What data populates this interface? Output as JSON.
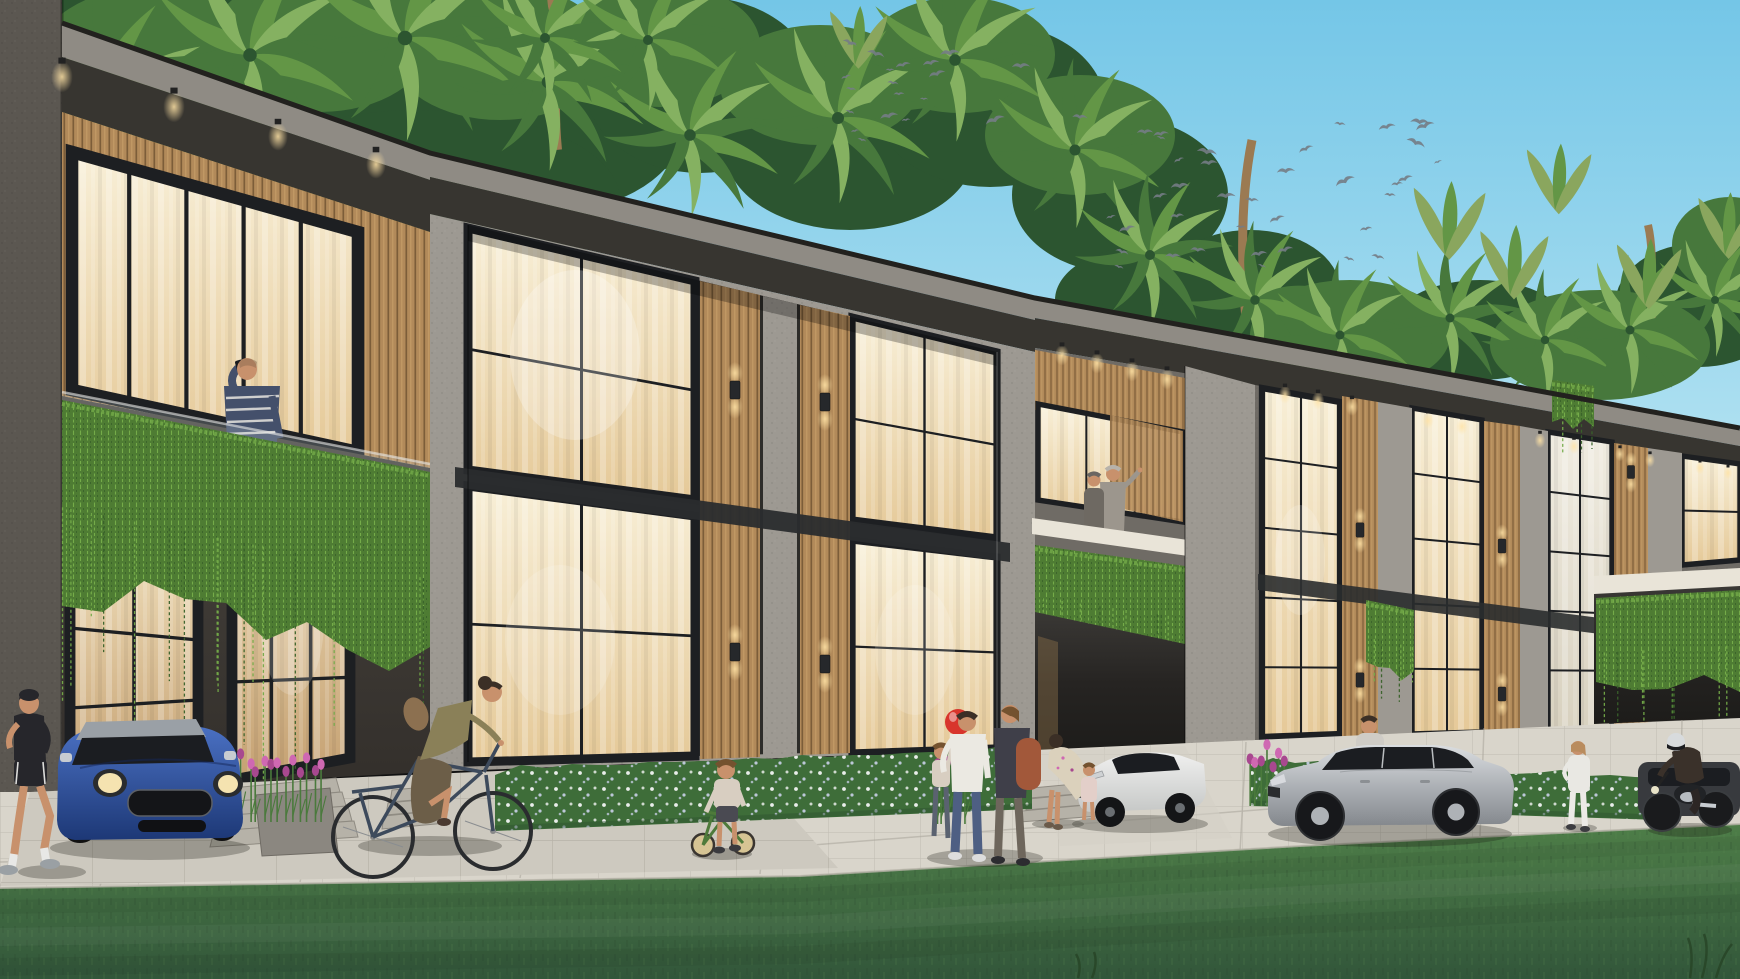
{
  "meta": {
    "title": "Architectural rendering of a modern two-storey tropical townhouse row at dusk",
    "type": "exterior-visualization",
    "no_visible_text": true
  },
  "palette": {
    "sky-top": "#74c6e7",
    "sky-bottom": "#c6ebf5",
    "canopy-dark": "#2c5530",
    "canopy-mid": "#47783c",
    "canopy-light": "#639646",
    "palm-light": "#85b161",
    "banana": "#8aa65e",
    "trunk": "#9b7a52",
    "bird": "#747c85",
    "fascia-light": "#8f8b84",
    "fascia-dark": "#373530",
    "roof-edge": "#22211e",
    "concrete-light": "#9d9992",
    "concrete-mid": "#6f6b65",
    "column": "#5b5751",
    "porch-1": "#49453f",
    "porch-2": "#332f2b",
    "reveal": "#2d2c29",
    "beam-dark": "#2a2c2e",
    "frame-black": "#1d1f22",
    "wood-mid": "#b28a5a",
    "wood-dark": "#7c5d39",
    "wood-light": "#caa26b",
    "glass-w1": "#f8efd7",
    "glass-w2": "#e5c998",
    "glass-p1": "#f0ece1",
    "glass-p2": "#d8d1bf",
    "door-w1": "#eedcb8",
    "door-w2": "#c5a172",
    "glow": "#ffdf9d",
    "vine": "#4e7c33",
    "vine-light": "#74ab49",
    "vine-dark": "#39622a",
    "hedge": "#3e6d39",
    "hedge-dark": "#2d5230",
    "flower-white": "#e9edea",
    "flower-blue": "#c3cbe0",
    "tulip": "#cf68b2",
    "tulip-deep": "#a8488f",
    "stem": "#4a7a3c",
    "slab-white": "#e9e4d8",
    "rail-glass": "#cfdade",
    "lawn-1": "#4e7e48",
    "lawn-2": "#32563a",
    "walkway": "#d9d5cb",
    "apron": "#cdc9bf",
    "paver-line": "#a8a49a",
    "step": "#b6b2a8",
    "shadow": "rgba(24,24,16,0.27)",
    "mini-1": "#4a70c2",
    "mini-2": "#1d3876",
    "mini-roof": "#9aa0a6",
    "car-white-1": "#f0f0ef",
    "car-white-2": "#c6c8c7",
    "car-silver-1": "#dadde0",
    "car-silver-2": "#a9adb2",
    "car-silver-3": "#84888d",
    "car-dark": "#383a3e",
    "car-glass": "#1b1d21",
    "chrome": "#c7ccd1",
    "moto": "#1a1b1d",
    "helmet": "#d8dbdd",
    "skin": "#c8916c",
    "hair-dark": "#3b2f26",
    "hair-brown": "#74522f",
    "hair-gray": "#b7b2aa",
    "jog-black": "#26262b",
    "cyc-olive": "#8a8058",
    "cyc-skirt": "#6c5e48",
    "bag-tan": "#8c7050",
    "shirt-white": "#ebe9e2",
    "jeans": "#4e5f83",
    "jacket-dark": "#3f3f49",
    "backpack": "#a2583a",
    "dress-cream": "#dbd1bc",
    "kid-top": "#d8cec1",
    "stripe-navy": "#44506b",
    "pants-cream": "#e6dbc1",
    "sweater-gray": "#9c968d",
    "fig-dark": "#6e6962",
    "white-out": "#e9e8e3",
    "balloon": "#d8352c"
  },
  "scene": {
    "sky": {
      "description": "clear blue gradient sky, brighter toward horizon"
    },
    "birds": {
      "target": "birds-layer",
      "flocks": [
        {
          "cx": 905,
          "cy": 92,
          "sx": 120,
          "sy": 50,
          "count": 20
        },
        {
          "cx": 1258,
          "cy": 190,
          "sx": 180,
          "sy": 80,
          "count": 38
        }
      ]
    },
    "vegetation": {
      "description": "dense palm and banana canopy behind the roofline; cascading vine planters; flowering hedges; mown lawn foreground",
      "vine_masses": [
        {
          "target": "vine-v1",
          "x1": 62,
          "y1": 400,
          "x2": 430,
          "y2": 472,
          "d": 195,
          "strands": 16
        },
        {
          "target": "vine-v4",
          "x1": 1035,
          "y1": 545,
          "x2": 1185,
          "y2": 566,
          "d": 95,
          "strands": 9
        },
        {
          "target": "vine-vC",
          "x1": 1366,
          "y1": 600,
          "x2": 1414,
          "y2": 610,
          "d": 68,
          "strands": 5
        },
        {
          "target": "vine-vD",
          "x1": 1596,
          "y1": 598,
          "x2": 1740,
          "y2": 590,
          "d": 100,
          "strands": 9
        },
        {
          "target": "vine-vE",
          "x1": 1552,
          "y1": 380,
          "x2": 1594,
          "y2": 386,
          "d": 42,
          "strands": 4
        }
      ],
      "hedges": [
        {
          "x1": 495,
          "y1": 775,
          "x2": 1032,
          "y2": 753,
          "h": 56
        },
        {
          "x1": 1250,
          "y1": 766,
          "x2": 1340,
          "y2": 768,
          "h": 40
        },
        {
          "x1": 1412,
          "y1": 774,
          "x2": 1660,
          "y2": 782,
          "h": 38
        }
      ],
      "tulip_beds": [
        {
          "x": 238,
          "y": 752,
          "w": 88,
          "h": 62,
          "n": 12
        },
        {
          "x": 934,
          "y": 756,
          "w": 34,
          "h": 60,
          "n": 6
        },
        {
          "x": 1248,
          "y": 748,
          "w": 38,
          "h": 50,
          "n": 7
        }
      ]
    },
    "building": {
      "storeys": 2,
      "units_visible": 7,
      "features": [
        "dark textured concrete facades",
        "vertical timber slat cladding",
        "full-height black-framed glazing with warm interior light",
        "glass balustrade balconies",
        "cascading planter vines",
        "recessed fascia downlights",
        "up-down wall sconces on timber piers",
        "white flower hedges",
        "entry steps",
        "carports"
      ],
      "windows": [
        {
          "target": "win-u1",
          "q": [
            72,
            152,
            358,
            232,
            358,
            452,
            72,
            390
          ],
          "cols": 5,
          "rows": 1,
          "f": 7,
          "fill": "warm"
        },
        {
          "target": "win-door",
          "q": [
            232,
            486,
            350,
            516,
            350,
            758,
            232,
            780
          ],
          "cols": 3,
          "rows": 3,
          "f": 6,
          "fill": "door"
        },
        {
          "target": "win-ug",
          "q": [
            70,
            548,
            198,
            580,
            198,
            760,
            70,
            788
          ],
          "cols": 2,
          "rows": 3,
          "f": 6,
          "fill": "door"
        },
        {
          "target": "win-bayA",
          "q": [
            468,
            228,
            695,
            281,
            695,
            500,
            468,
            470
          ],
          "cols": 2,
          "rows": 2,
          "f": 5,
          "fill": "warm"
        },
        {
          "target": "win-bayA",
          "q": [
            468,
            486,
            695,
            516,
            695,
            756,
            468,
            762
          ],
          "cols": 2,
          "rows": 2,
          "f": 5,
          "fill": "warm"
        },
        {
          "target": "win-bayA",
          "q": [
            852,
            317,
            997,
            352,
            997,
            538,
            852,
            520
          ],
          "cols": 2,
          "rows": 2,
          "f": 4,
          "fill": "warm"
        },
        {
          "target": "win-bayA",
          "q": [
            852,
            540,
            997,
            557,
            997,
            748,
            852,
            753
          ],
          "cols": 2,
          "rows": 2,
          "f": 4,
          "fill": "warm"
        },
        {
          "target": "win-u4",
          "q": [
            1038,
            404,
            1183,
            432,
            1183,
            522,
            1038,
            500
          ],
          "cols": 3,
          "rows": 1,
          "f": 3,
          "fill": "warm"
        },
        {
          "target": "win-right",
          "q": [
            1262,
            388,
            1340,
            402,
            1340,
            734,
            1262,
            737
          ],
          "cols": 2,
          "rows": 5,
          "f": 3.5,
          "fill": "warm"
        },
        {
          "target": "win-right",
          "q": [
            1412,
            408,
            1482,
            420,
            1482,
            732,
            1412,
            734
          ],
          "cols": 2,
          "rows": 5,
          "f": 3,
          "fill": "warm"
        },
        {
          "target": "win-right",
          "q": [
            1548,
            432,
            1612,
            442,
            1612,
            728,
            1548,
            730
          ],
          "cols": 2,
          "rows": 5,
          "f": 3,
          "fill": "pale"
        },
        {
          "target": "win-right",
          "q": [
            1682,
            456,
            1740,
            464,
            1740,
            560,
            1682,
            565
          ],
          "cols": 1,
          "rows": 2,
          "f": 3,
          "fill": "warm"
        }
      ],
      "downlights": [
        [
          62,
          72,
          1.2
        ],
        [
          174,
          102,
          1.2
        ],
        [
          278,
          132,
          1.1
        ],
        [
          376,
          160,
          1.1
        ],
        [
          1062,
          352,
          0.8
        ],
        [
          1097,
          360,
          0.8
        ],
        [
          1132,
          368,
          0.8
        ],
        [
          1167,
          376,
          0.8
        ],
        [
          1285,
          392,
          0.7
        ],
        [
          1318,
          398,
          0.7
        ],
        [
          1352,
          404,
          0.7
        ],
        [
          1428,
          418,
          0.65
        ],
        [
          1462,
          424,
          0.65
        ],
        [
          1540,
          438,
          0.6
        ],
        [
          1574,
          444,
          0.6
        ],
        [
          1620,
          452,
          0.55
        ],
        [
          1650,
          458,
          0.55
        ],
        [
          1700,
          466,
          0.5
        ],
        [
          1728,
          471,
          0.5
        ]
      ],
      "sconces": [
        [
          735,
          390,
          1
        ],
        [
          825,
          402,
          1
        ],
        [
          735,
          652,
          1
        ],
        [
          825,
          664,
          1
        ],
        [
          1360,
          530,
          0.8
        ],
        [
          1360,
          680,
          0.8
        ],
        [
          1502,
          546,
          0.78
        ],
        [
          1502,
          694,
          0.78
        ],
        [
          1631,
          472,
          0.72
        ]
      ]
    },
    "vehicles": [
      {
        "label": "blue mini hatchback parked by first unit",
        "color_key": "mini-1"
      },
      {
        "label": "white sports coupe parked in carport",
        "color_key": "car-white-1"
      },
      {
        "label": "silver estate sedan parked on walkway",
        "color_key": "car-silver-1"
      },
      {
        "label": "dark gray car in far-right carport",
        "color_key": "car-dark"
      },
      {
        "label": "black motorcycle with rider",
        "color_key": "moto"
      }
    ],
    "people": [
      {
        "label": "jogger walking past the first townhouse",
        "position": "far left"
      },
      {
        "label": "man talking on phone on first balcony",
        "position": "left balcony"
      },
      {
        "label": "woman riding a bicycle",
        "position": "left sidewalk"
      },
      {
        "label": "boy standing with a green balance bike",
        "position": "center sidewalk"
      },
      {
        "label": "family of three with a red balloon",
        "position": "center-right sidewalk"
      },
      {
        "label": "woman bending to help a toddler",
        "position": "beside white sports car"
      },
      {
        "label": "couple admiring the view from central balcony",
        "position": "middle unit balcony"
      },
      {
        "label": "person standing behind the silver sedan",
        "position": "right"
      },
      {
        "label": "woman in white standing on sidewalk",
        "position": "right"
      },
      {
        "label": "motorcyclist riding past far carport",
        "position": "far right"
      }
    ]
  }
}
